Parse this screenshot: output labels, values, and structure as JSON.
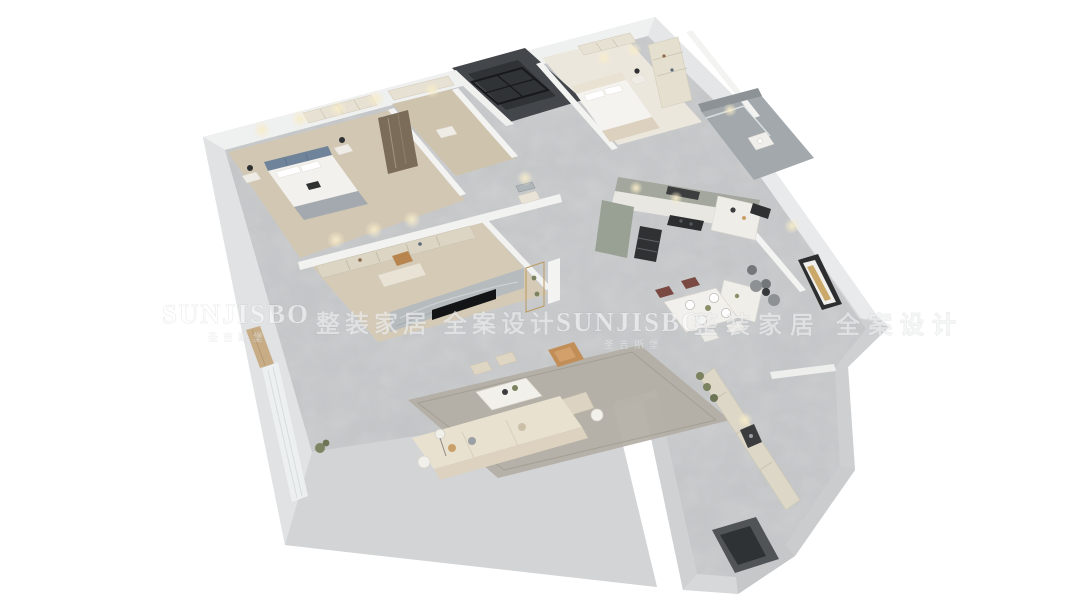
{
  "image": {
    "kind": "3d-floor-plan-render",
    "description": "isometric cutaway render of an apartment interior",
    "width_px": 1080,
    "height_px": 608
  },
  "watermark": {
    "color": "#ffffff",
    "opacity": 0.55,
    "items": [
      {
        "brand": "SUNJISBO",
        "sub": "圣吉斯堡"
      },
      {
        "phrase": "整装家居 全案设计"
      },
      {
        "brand": "SUNJISBO",
        "sub": "圣吉斯堡"
      },
      {
        "phrase": "整装家居 全案设计"
      }
    ]
  },
  "scene": {
    "rooms": [
      "master-bedroom",
      "walk-in-closet",
      "elevator-shaft",
      "second-bedroom",
      "bathroom",
      "hallway",
      "study-dressing-room",
      "living-room",
      "kitchen",
      "dining-area",
      "tea-room",
      "pantry-laundry",
      "curtained-balcony"
    ],
    "furniture": [
      "double-bed",
      "tufted-headboard",
      "nightstands",
      "table-lamps",
      "built-in-wardrobes",
      "hanging-clothes",
      "bookshelves",
      "desk",
      "desk-chair",
      "marble-tv-wall",
      "television",
      "display-shelf",
      "sofa",
      "coffee-table",
      "ottomans",
      "lounge-chair",
      "area-rug",
      "floor-lamp",
      "side-table",
      "kitchen-cabinets",
      "range-hood",
      "cooktop",
      "oven-tower",
      "tall-cabinet",
      "kitchen-island",
      "bar-counter",
      "bar-stools",
      "dining-table",
      "dining-chairs",
      "tableware",
      "wall-art",
      "cafe-table-chairs",
      "pantry-cabinets",
      "appliance-niche",
      "entry-doorway",
      "sheer-curtains",
      "potted-plants",
      "shower-enclosure",
      "vanity-console",
      "mirror"
    ],
    "palette": {
      "background": "#ffffff",
      "outer_wall": "#d7d8da",
      "wall_top_face": "#eff0f0",
      "wall_shadow_face": "#c6c8ca",
      "marble_floor": "#c7c9cb",
      "wood_floor": "#d2c7b3",
      "dark_shaft": "#43464a",
      "cabinet_cream": "#e6e0d1",
      "kitchen_sage": "#a4a79d",
      "sofa_cream": "#e9e1d0",
      "accent_tan": "#c28e58",
      "accent_maroon": "#7a4a42",
      "tv_wall_marble": "#b6bbbe",
      "warm_glow": "#f3e6c2",
      "greenery": "#7b8260"
    }
  }
}
